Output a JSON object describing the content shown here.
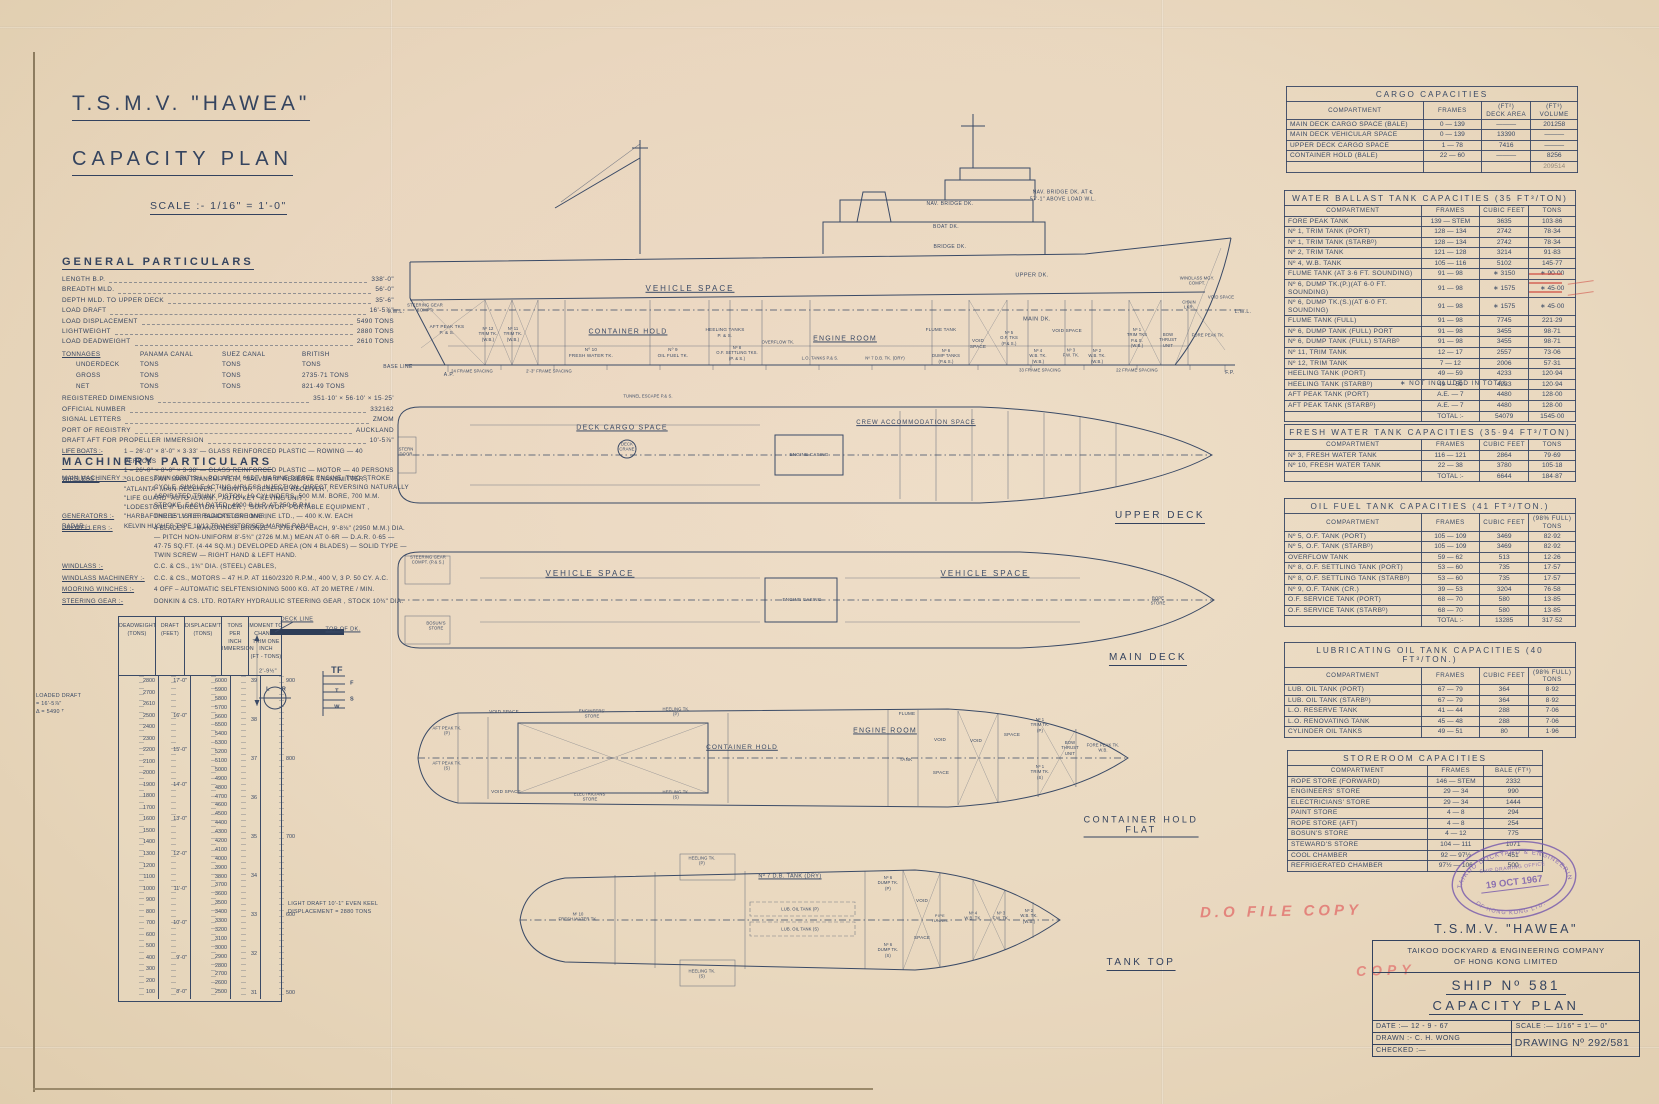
{
  "title": {
    "ship": "T.S.M.V. \"HAWEA\"",
    "plan": "CAPACITY PLAN",
    "scale": "SCALE :-  1/16\" = 1'-0\""
  },
  "general": {
    "heading": "GENERAL PARTICULARS",
    "rows": [
      [
        "LENGTH B.P.",
        "338'-0\""
      ],
      [
        "BREADTH MLD.",
        "56'-0\""
      ],
      [
        "DEPTH MLD. TO UPPER DECK",
        "35'-6\""
      ],
      [
        "LOAD DRAFT",
        "16'-5⅞\""
      ],
      [
        "LOAD DISPLACEMENT",
        "5490 TONS"
      ],
      [
        "LIGHTWEIGHT",
        "2880 TONS"
      ],
      [
        "LOAD DEADWEIGHT",
        "2610 TONS"
      ]
    ],
    "tonnages": {
      "label": "TONNAGES",
      "cols": [
        "PANAMA CANAL",
        "SUEZ CANAL",
        "BRITISH"
      ],
      "rows": [
        [
          "UNDERDECK",
          "TONS",
          "TONS",
          "TONS"
        ],
        [
          "GROSS",
          "TONS",
          "TONS",
          "2735·71 TONS"
        ],
        [
          "NET",
          "TONS",
          "TONS",
          "821·49 TONS"
        ]
      ]
    },
    "rows2": [
      [
        "REGISTERED DIMENSIONS",
        "351·10'  ×  56·10'  ×  15·25'"
      ],
      [
        "OFFICIAL NUMBER",
        "332162"
      ],
      [
        "SIGNAL LETTERS",
        "ZMOM"
      ],
      [
        "PORT OF REGISTRY",
        "AUCKLAND"
      ],
      [
        "DRAFT AFT FOR PROPELLER IMMERSION",
        "10'-5⅞\""
      ]
    ],
    "life_boats_label": "LIFE BOATS :-",
    "life_boats": [
      "1 – 26'-0\" × 8'-0\" × 3·33' — GLASS REINFORCED PLASTIC — ROWING — 40 PERSONS",
      "1 – 26'-0\" × 8'-0\" × 3·38' — GLASS REINFORCED PLASTIC — MOTOR — 40 PERSONS"
    ],
    "wireless_label": "WIRELESS :-",
    "wireless": [
      "\"GLOBESPAN\"  MAIN TRANSMITTER ,      \"SALVOR II\"  RESERVE TRANSMITTER ,",
      "\"ATLANTA\"  MAIN RECEIVER ,      \"MONITOR\"  RESERVE RECEIVER ,",
      "\"LIFE GUARD\"  AUTO ALARM ,      \"AUTO KEY\"  KEYING UNIT ,",
      "\"LODESTONE II\"  DIRECTION FINDER ,      \"SURVIVOR\"  PORTABLE EQUIPMENT ,",
      "\"HARBAFONE 15\"  V.H.F. RADIOTELEPHONE ,"
    ],
    "radar_label": "RADAR :-",
    "radar": "KELVIN HUGHES TYPE 19/12 TRANSISTORISED MARINE RADAR."
  },
  "machinery": {
    "heading": "MACHINERY PARTICULARS",
    "entries": [
      [
        "MAIN MACHINERY :-",
        "TWIN \"BRITISH - POLAR\" M 66DT. MARINE DIESEL ENGINE, TWO STROKE CYCLE, SINGLE ACTING AIRLESS INJECTION, DIRECT REVERSING NATURALLY ASPIRATED TRUNK PISTON, 10 CYLINDERS, 500 M.M. BORE, 700 M.M. STROKE, EACH RATED, 4000 B.H.P. AT 250 R.P.M."
      ],
      [
        "GENERATORS :-",
        "THREE LISTER BLACKSTONE MARINE LTD., — 400 K.W. EACH"
      ],
      [
        "PROPELLERS :-",
        "4 BLADES — MANGANESE BRONZE — 2781 KG. EACH, 9'-8⅛\" (2950 M.M.) DIA. — PITCH NON-UNIFORM 8'-5¾\" (2726 M.M.) MEAN AT 0·6R — D.A.R. 0·65 — 47·75 SQ.FT. (4·44 SQ.M.) DEVELOPED AREA (ON 4 BLADES) — SOLID TYPE — TWIN SCREW — RIGHT HAND & LEFT HAND."
      ],
      [
        "WINDLASS :-",
        "C.C. & CS.,   1¾\" DIA. (STEEL) CABLES,"
      ],
      [
        "WINDLASS MACHINERY :-",
        "C.C. & CS.,   MOTORS – 47 H.P. AT 1160/2320 R.P.M., 400 V, 3 P. 50 CY. A.C."
      ],
      [
        "MOORING WINCHES :-",
        "4 OFF – AUTOMATIC SELFTENSIONING  5000 KG. AT 20 METRE / MIN."
      ],
      [
        "STEERING GEAR :-",
        "DONKIN & CS. LTD. ROTARY HYDRAULIC STEERING GEAR , STOCK 10¾\" DIA."
      ]
    ]
  },
  "dwscale": {
    "headers": [
      "DEADWEIGHT\n(TONS)",
      "DRAFT\n(FEET)",
      "DISPLACEM'T\n(TONS)",
      "TONS\nPER INCH\nIMMERSION",
      "MOMENT TO\nCHANGE\nTRIM ONE\nINCH\n(FT - TONS)"
    ],
    "deadweight": [
      "2800",
      "2700",
      "2610",
      "2500",
      "2400",
      "2300",
      "2200",
      "2100",
      "2000",
      "1900",
      "1800",
      "1700",
      "1600",
      "1500",
      "1400",
      "1300",
      "1200",
      "1100",
      "1000",
      "900",
      "800",
      "700",
      "600",
      "500",
      "400",
      "300",
      "200",
      "100"
    ],
    "draft": [
      "17'-0\"",
      "16'-0\"",
      "15'-0\"",
      "14'-0\"",
      "13'-0\"",
      "12'-0\"",
      "11'-0\"",
      "10'-0\"",
      "9'-0\"",
      "8'-0\""
    ],
    "displacement": [
      "6000",
      "5900",
      "5800",
      "5700",
      "5600",
      "5500",
      "5400",
      "5300",
      "5200",
      "5100",
      "5000",
      "4900",
      "4800",
      "4700",
      "4600",
      "4500",
      "4400",
      "4300",
      "4200",
      "4100",
      "4000",
      "3900",
      "3800",
      "3700",
      "3600",
      "3500",
      "3400",
      "3300",
      "3200",
      "3100",
      "3000",
      "2900",
      "2800",
      "2700",
      "2600",
      "2500"
    ],
    "tpi": [
      "39",
      "38",
      "37",
      "36",
      "35",
      "34",
      "33",
      "32",
      "31"
    ],
    "mct": [
      "900",
      "800",
      "700",
      "600",
      "500"
    ],
    "loaded_note": "LOADED DRAFT\n= 16'-5⅞\"\nΔ = 5490 ᵀ",
    "light_note": "LIGHT DRAFT 10'-1\"  EVEN KEEL\nDISPLACEMENT = 2880 TONS"
  },
  "loadline": {
    "deck_line": "DECK LINE",
    "top_of_dk": "TOP OF DK.",
    "dim": "2'-9½\"",
    "letters": [
      "TF",
      "F",
      "T",
      "S",
      "W"
    ],
    "lr": [
      "L",
      "R"
    ]
  },
  "profile": {
    "nav_note": "NAV. BRIDGE DK. AT ℄\n57'-1\" ABOVE LOAD W.L.",
    "nav_bridge": "NAV. BRIDGE DK.",
    "boat": "BOAT DK.",
    "bridge": "BRIDGE DK.",
    "upper": "UPPER DK.",
    "main": "MAIN DK.",
    "vehicle": "VEHICLE SPACE",
    "engine_room": "ENGINE ROOM",
    "container_hold": "CONTAINER HOLD",
    "fw10": "Nº 10\nFRESH WATER TK.",
    "of9": "Nº 9\nOIL FUEL TK.",
    "heeling": "HEELING TANKS\nP. & S.",
    "of8": "Nº 8\nO.F. SETTLING TKS.\n(P. & S.)",
    "overflow": "OVERFLOW TK.",
    "aft_peak": "AFT PEAK TKS\nP. & S.",
    "steering": "STEERING GEAR\nCOMPT.",
    "trim12": "Nº 12\nTRIM TK.\n(W.B.)",
    "trim11": "Nº 11\nTRIM TK.\n(W.B.)",
    "lwl_l": "L.W.L.",
    "lwl_r": "L.W.L.",
    "base_line": "BASE LINE",
    "flume": "FLUME TANK",
    "dump": "Nº 6\nDUMP TANKS\n(P.& S.)",
    "void1": "VOID\nSPACE",
    "of5": "Nº 5\nO.F. TKS\n(P.& S.)",
    "void2": "VOID SPACE",
    "wb4": "Nº 4\nW.B. TK.\n(W.B.)",
    "fw3": "Nº 3\nF.W. TK.",
    "wb2": "Nº 2\nW.B. TK.\n(W.B.)",
    "trim1": "Nº 1\nTRIM TKS\nP.& S.\n(W.B.)",
    "bow_thrust": "BOW\nTHRUST\nUNIT",
    "fore_peak": "FORE PEAK TK.",
    "windlass": "WINDLASS MGY.\nCOMPT.",
    "chain": "CHAIN\nLKR.",
    "void3": "VOID SPACE",
    "lo_tanks": "L.O. TANKS  P.& S.",
    "db7": "Nº 7 D.B. TK. (DRY)",
    "ap": "A.P.",
    "fp": "F.P.",
    "fs1": "24 FRAME SPACING",
    "fs2": "2'-3\" FRAME SPACING",
    "fs3": "33 FRAME SPACING",
    "fs4": "22 FRAME SPACING"
  },
  "upper_deck": {
    "caption": "UPPER DECK",
    "tunnel_escape": "TUNNEL ESCAPE  P.& S.",
    "cargo": "DECK CARGO SPACE",
    "crew": "CREW ACCOMMODATION SPACE",
    "casing": "ENGINE CASING",
    "crane": "DECK\nCRANE",
    "stern_door": "STERN\nDOOR"
  },
  "main_deck": {
    "caption": "MAIN DECK",
    "vehicle_aft": "VEHICLE SPACE",
    "casing": "ENGINE CASING",
    "vehicle_fwd": "VEHICLE SPACE",
    "steering": "STEERING GEAR\nCOMPT. (P.& S.)",
    "bosun": "BOSUN'S\nSTORE",
    "rope": "ROPE\nSTORE"
  },
  "chf": {
    "caption": "CONTAINER HOLD\nFLAT",
    "aft_peak_p": "AFT PEAK TK.\n(P)",
    "aft_peak_s": "AFT PEAK TK.\n(S)",
    "void_t": "VOID SPACE",
    "void_b": "VOID SPACE",
    "eng_store": "ENGINEERS'\nSTORE",
    "elect_store": "ELECTRICIANS'\nSTORE",
    "heeling_p": "HEELING TK.\n(P)",
    "heeling_s": "HEELING TK.\n(S)",
    "container_hold": "CONTAINER HOLD",
    "engine_room": "ENGINE ROOM",
    "flume": "FLUME",
    "tank": "TANK",
    "void_m": "VOID",
    "space_m": "SPACE",
    "void_r": "VOID",
    "space_r": "SPACE",
    "trim1_p": "Nº 1\nTRIM TK.\n(P)",
    "trim1_s": "Nº 1\nTRIM TK.\n(S)",
    "bow_thrust": "BOW\nTHRUST\nUNIT",
    "fore_peak": "FORE PEAK TK.\nW.B."
  },
  "tank_top": {
    "caption": "TANK TOP",
    "heeling_p": "HEELING TK.\n(P)",
    "heeling_s": "HEELING TK.\n(S)",
    "db7": "Nº 7 D.B. TANK (DRY)",
    "fw10": "Nº 10\nFRESH WATER TK.",
    "lub_p": "LUB. OIL TANK (P)",
    "lub_s": "LUB. OIL TANK (S)",
    "dump_p": "Nº 6\nDUMP TK.\n(P)",
    "dump_s": "Nº 6\nDUMP TK.\n(S)",
    "void": "VOID",
    "space": "SPACE",
    "pipe": "PIPE\nTUNNEL",
    "wb4": "Nº 4\nW.B. TK.",
    "fw3": "Nº 3\nF.W. TK.",
    "wb2": "Nº 2\nW.B. TK.\n(W.B.)"
  },
  "tables": {
    "cargo": {
      "title": "CARGO    CAPACITIES",
      "headers": [
        "COMPARTMENT",
        "FRAMES",
        "(FT²)\nDECK AREA",
        "(FT³)\nVOLUME"
      ],
      "rows": [
        [
          "MAIN DECK CARGO SPACE  (BALE)",
          "0 — 139",
          "———",
          "201258"
        ],
        [
          "MAIN DECK VEHICULAR SPACE",
          "0 — 139",
          "13390",
          "———"
        ],
        [
          "UPPER DECK CARGO SPACE",
          "1 — 78",
          "7416",
          "———"
        ],
        [
          "CONTAINER HOLD  (BALE)",
          "22 — 60",
          "———",
          "8256"
        ],
        [
          "",
          "",
          "",
          "209514"
        ]
      ]
    },
    "ballast": {
      "title": "WATER BALLAST TANK CAPACITIES    (35 FT³/TON)",
      "headers": [
        "COMPARTMENT",
        "FRAMES",
        "CUBIC FEET",
        "TONS"
      ],
      "rows": [
        [
          "FORE PEAK TANK",
          "139 — STEM",
          "3635",
          "103·86"
        ],
        [
          "Nº 1,  TRIM TANK   (PORT)",
          "128 — 134",
          "2742",
          "78·34"
        ],
        [
          "Nº 1,  TRIM TANK   (STARBᴰ)",
          "128 — 134",
          "2742",
          "78·34"
        ],
        [
          "Nº 2,  TRIM TANK",
          "121 — 128",
          "3214",
          "91·83"
        ],
        [
          "Nº 4,  W.B. TANK",
          "105 — 116",
          "5102",
          "145·77"
        ],
        [
          "FLUME TANK (AT 3·6 FT. SOUNDING)",
          "91 — 98",
          "∗ 3150",
          "∗ 90·00"
        ],
        [
          "Nº 6, DUMP TK.(P.)(AT 6·0 FT. SOUNDING)",
          "91 — 98",
          "∗ 1575",
          "∗ 45·00"
        ],
        [
          "Nº 6, DUMP TK.(S.)(AT 6·0 FT. SOUNDING)",
          "91 — 98",
          "∗ 1575",
          "∗ 45·00"
        ],
        [
          "FLUME TANK      (FULL)",
          "91 — 98",
          "7745",
          "221·29"
        ],
        [
          "Nº 6, DUMP TANK   (FULL)  PORT",
          "91 — 98",
          "3455",
          "98·71"
        ],
        [
          "Nº 6, DUMP TANK   (FULL)  STARBᴰ",
          "91 — 98",
          "3455",
          "98·71"
        ],
        [
          "Nº 11,  TRIM TANK",
          "12 — 17",
          "2557",
          "73·06"
        ],
        [
          "Nº 12,  TRIM TANK",
          "7 — 12",
          "2006",
          "57·31"
        ],
        [
          "HEELING TANK    (PORT)",
          "49 — 59",
          "4233",
          "120·94"
        ],
        [
          "HEELING TANK    (STARBᴰ)",
          "49 — 59",
          "4233",
          "120·94"
        ],
        [
          "AFT PEAK TANK  (PORT)",
          "A.E. —  7",
          "4480",
          "128·00"
        ],
        [
          "AFT PEAK TANK  (STARBᴰ)",
          "A.E. —  7",
          "4480",
          "128·00"
        ],
        [
          "",
          "TOTAL :-",
          "54079",
          "1545·00"
        ]
      ],
      "note": "∗  NOT INCLUDED IN TOTAL"
    },
    "fresh": {
      "title": "FRESH  WATER  TANK  CAPACITIES  (35·94 FT³/TON)",
      "headers": [
        "COMPARTMENT",
        "FRAMES",
        "CUBIC FEET",
        "TONS"
      ],
      "rows": [
        [
          "Nº 3, FRESH WATER TANK",
          "116 — 121",
          "2864",
          "79·69"
        ],
        [
          "Nº 10, FRESH WATER TANK",
          "22 — 38",
          "3780",
          "105·18"
        ],
        [
          "",
          "TOTAL :-",
          "6644",
          "184·87"
        ]
      ]
    },
    "oil": {
      "title": "OIL  FUEL  TANK  CAPACITIES     (41 FT³/TON.)",
      "headers": [
        "COMPARTMENT",
        "FRAMES",
        "CUBIC FEET",
        "(98% FULL)\nTONS"
      ],
      "rows": [
        [
          "Nº 5, O.F. TANK     (PORT)",
          "105 — 109",
          "3469",
          "82·92"
        ],
        [
          "Nº 5, O.F. TANK     (STARBᴰ)",
          "105 — 109",
          "3469",
          "82·92"
        ],
        [
          "OVERFLOW TANK",
          "59 — 62",
          "513",
          "12·26"
        ],
        [
          "Nº 8, O.F. SETTLING TANK   (PORT)",
          "53 — 60",
          "735",
          "17·57"
        ],
        [
          "Nº 8, O.F. SETTLING TANK   (STARBᴰ)",
          "53 — 60",
          "735",
          "17·57"
        ],
        [
          "Nº 9, O.F. TANK     (CR.)",
          "39 — 53",
          "3204",
          "76·58"
        ],
        [
          "O.F. SERVICE TANK   (PORT)",
          "68 — 70",
          "580",
          "13·85"
        ],
        [
          "O.F. SERVICE TANK   (STARBᴰ)",
          "68 — 70",
          "580",
          "13·85"
        ],
        [
          "",
          "TOTAL :-",
          "13285",
          "317·52"
        ]
      ]
    },
    "lub": {
      "title": "LUBRICATING  OIL  TANK  CAPACITIES   (40 FT³/TON.)",
      "headers": [
        "COMPARTMENT",
        "FRAMES",
        "CUBIC FEET",
        "(98% FULL)\nTONS"
      ],
      "rows": [
        [
          "LUB. OIL TANK      (PORT)",
          "67 — 79",
          "364",
          "8·92"
        ],
        [
          "LUB. OIL TANK      (STARBᴰ)",
          "67 — 79",
          "364",
          "8·92"
        ],
        [
          "L.O. RESERVE  TANK",
          "41 — 44",
          "288",
          "7·06"
        ],
        [
          "L.O. RENOVATING  TANK",
          "45 — 48",
          "288",
          "7·06"
        ],
        [
          "CYLINDER  OIL  TANKS",
          "49 — 51",
          "80",
          "1·96"
        ]
      ]
    },
    "store": {
      "title": "STOREROOM     CAPACITIES",
      "headers": [
        "COMPARTMENT",
        "FRAMES",
        "BALE (FT³)"
      ],
      "rows": [
        [
          "ROPE  STORE   (FORWARD)",
          "146 — STEM",
          "2332"
        ],
        [
          "ENGINEERS'  STORE",
          "29 — 34",
          "990"
        ],
        [
          "ELECTRICIANS'  STORE",
          "29 — 34",
          "1444"
        ],
        [
          "PAINT  STORE",
          "4 — 8",
          "294"
        ],
        [
          "ROPE  STORE    (AFT)",
          "4 — 8",
          "254"
        ],
        [
          "BOSUN'S  STORE",
          "4 — 12",
          "775"
        ],
        [
          "STEWARD'S  STORE",
          "104 — 111",
          "1071"
        ],
        [
          "COOL  CHAMBER",
          "92 — 97½",
          "451"
        ],
        [
          "REFRIGERATED  CHAMBER",
          "97½ — 106",
          "500"
        ]
      ]
    }
  },
  "stamp": {
    "ring_top": "TAIKOO DOCKYARD & ENGINEERING CO.",
    "line1": "SHIP DRAWING OFFICE",
    "date": "19 OCT 1967",
    "ring_bottom": "OF HONG KONG LTD."
  },
  "title_block": {
    "ship": "T.S.M.V.  \"HAWEA\"",
    "company": "TAIKOO  DOCKYARD  &  ENGINEERING  COMPANY\nOF  HONG  KONG  LIMITED",
    "ship_no": "SHIP Nº 581",
    "plan": "CAPACITY  PLAN",
    "date": "DATE :— 12 - 9 - 67",
    "scale": "SCALE :—  1/16\" =  1'— 0\"",
    "drawn": "DRAWN :-  C. H. WONG",
    "checked": "CHECKED :—",
    "drawing_no": "DRAWING  Nº  292/581"
  },
  "red": {
    "file_copy": "D.O FILE COPY",
    "copy": "COPY"
  }
}
